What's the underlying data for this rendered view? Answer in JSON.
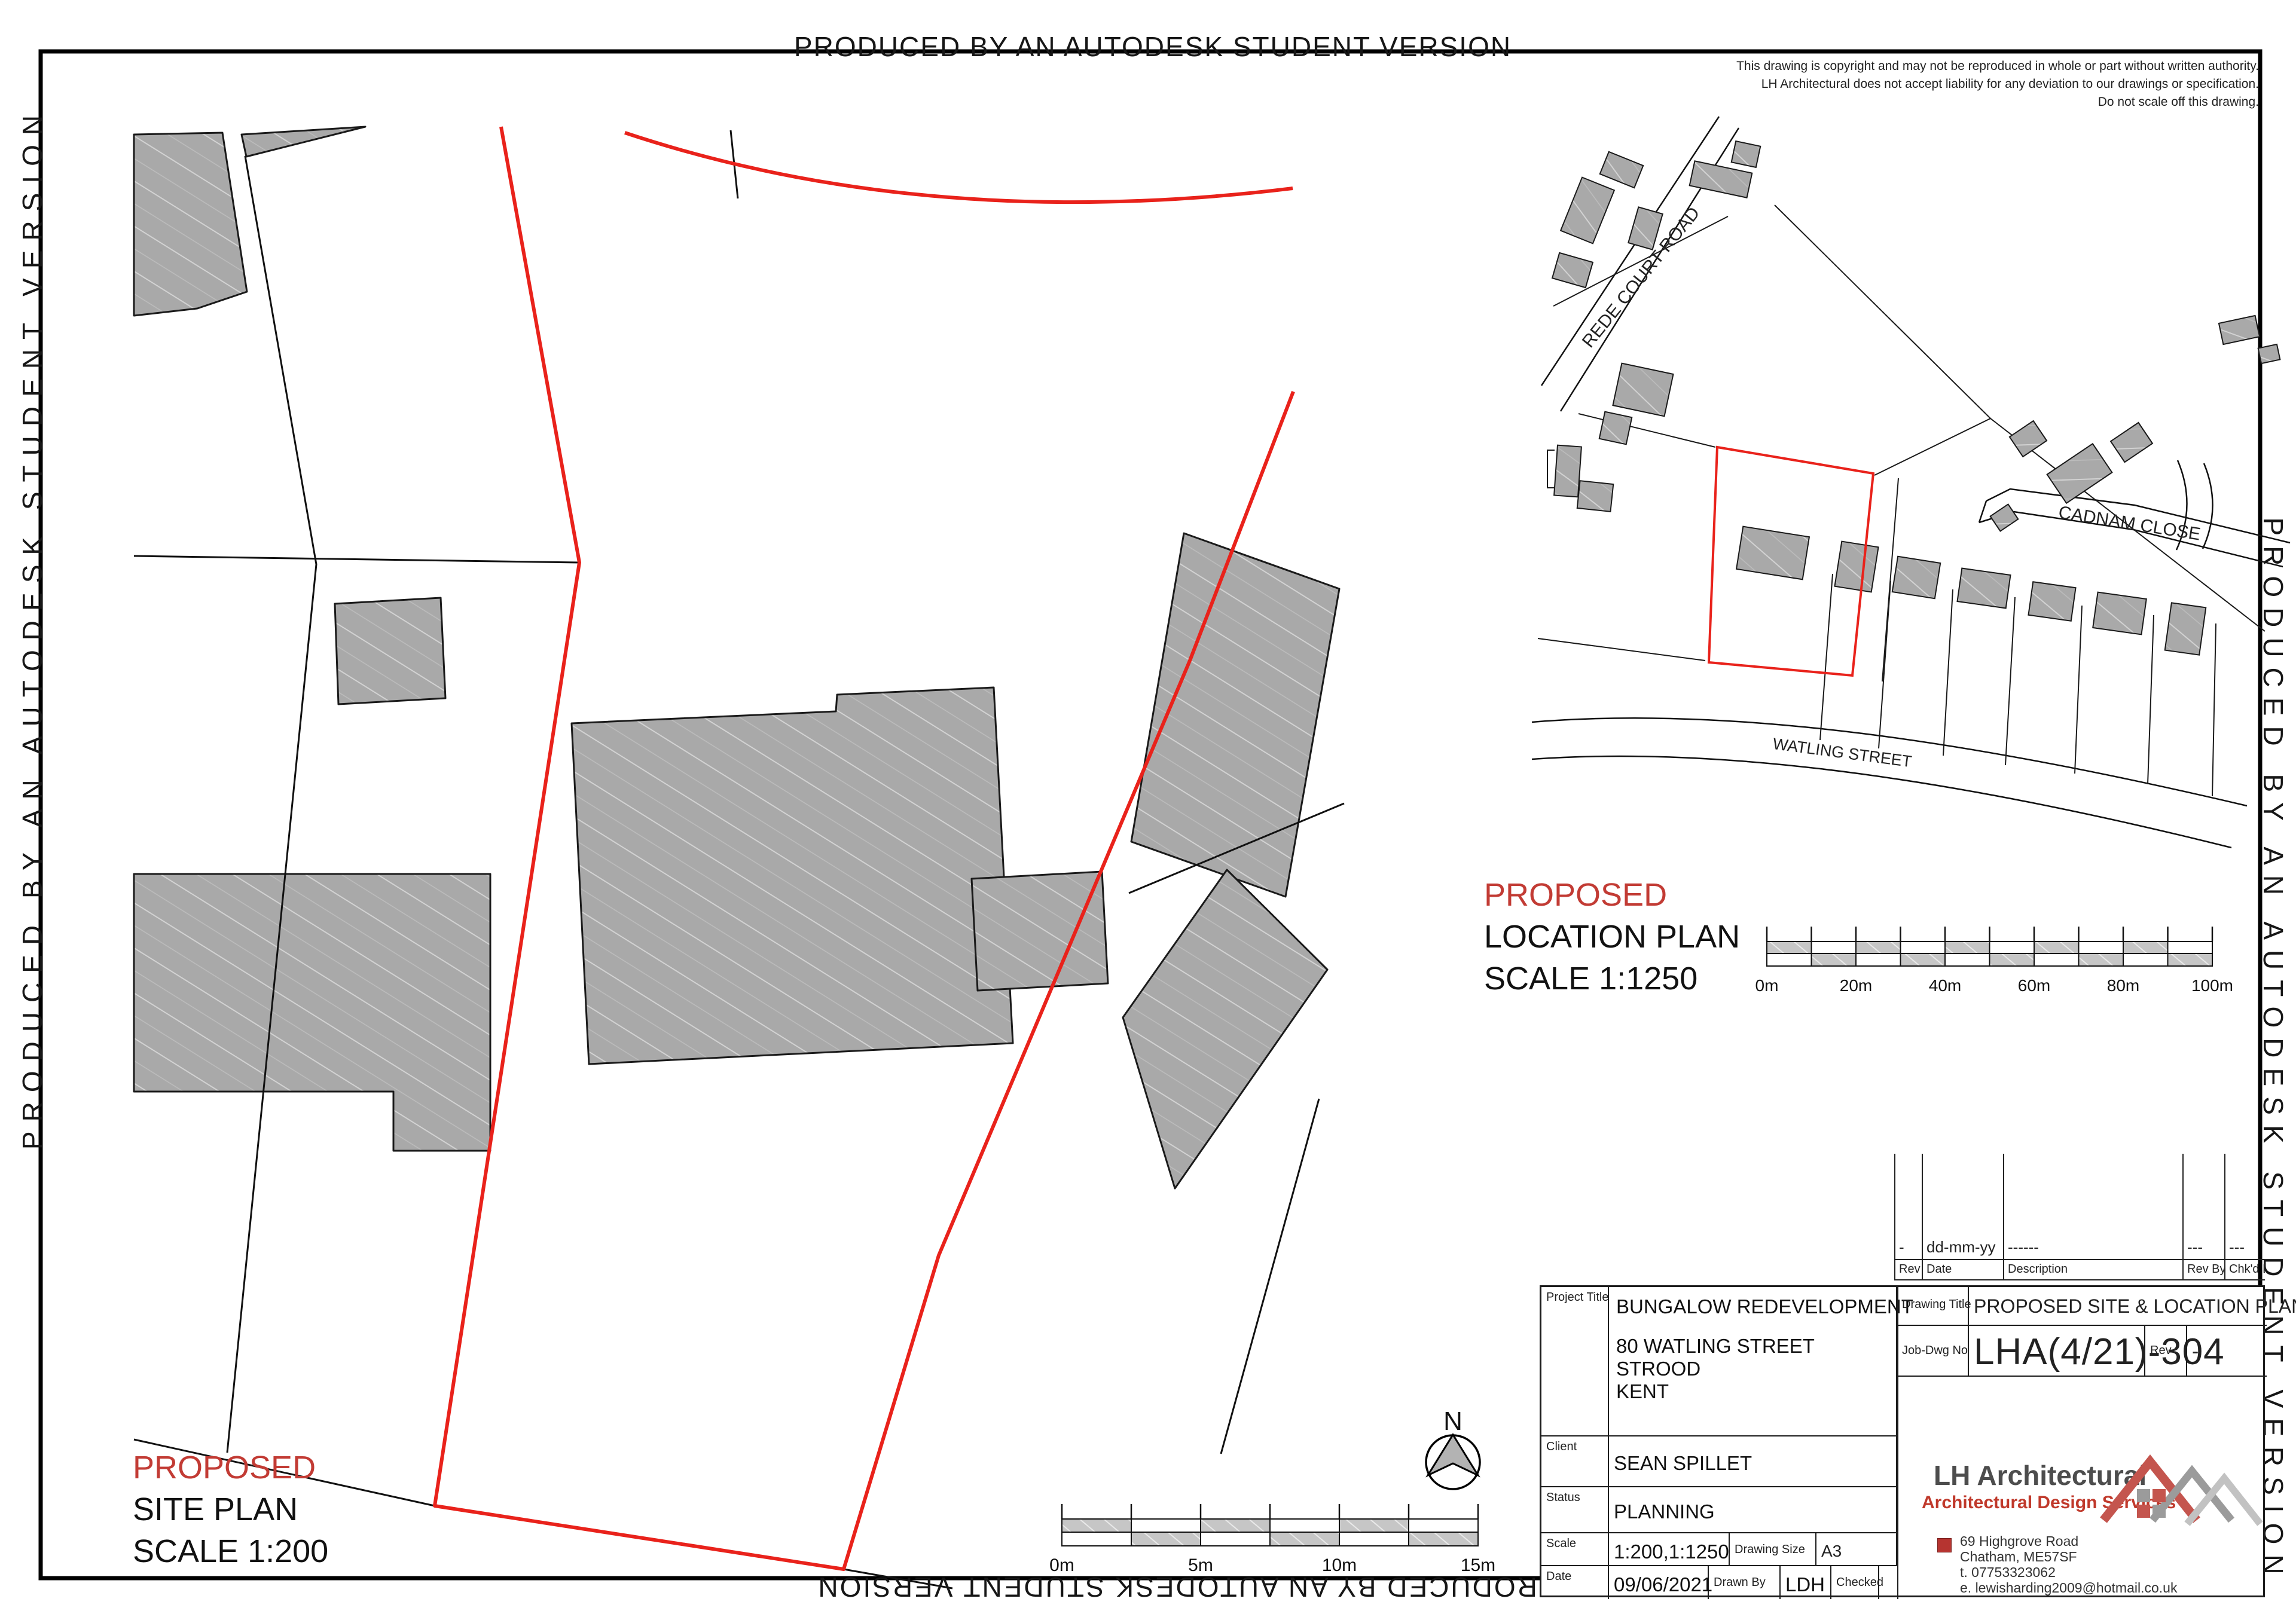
{
  "banner": {
    "text": "PRODUCED BY AN AUTODESK STUDENT VERSION"
  },
  "copyright": {
    "line1": "This drawing is copyright and may not be reproduced in whole or part without written authority.",
    "line2": "LH Architectural does not accept liability for any deviation to our drawings or specification.",
    "line3": "Do not scale off this drawing."
  },
  "location_plan": {
    "roads": {
      "rede": "REDE COURT ROAD",
      "cadnam": "CADNAM CLOSE",
      "watling": "WATLING STREET"
    },
    "caption": {
      "l1": "PROPOSED",
      "l2": "LOCATION PLAN",
      "l3": "SCALE 1:1250"
    },
    "scalebar": [
      "0m",
      "20m",
      "40m",
      "60m",
      "80m",
      "100m"
    ]
  },
  "site_plan": {
    "caption": {
      "l1": "PROPOSED",
      "l2": "SITE PLAN",
      "l3": "SCALE 1:200"
    },
    "scalebar": [
      "0m",
      "5m",
      "10m",
      "15m"
    ],
    "north_label": "N"
  },
  "revision_table": {
    "headers": [
      "Rev",
      "Date",
      "Description",
      "Rev By",
      "Chk'd By"
    ],
    "row": {
      "rev": "-",
      "date": "dd-mm-yy",
      "description": "------",
      "rev_by": "---",
      "chkd_by": "---"
    }
  },
  "title_block": {
    "labels": {
      "project_title": "Project Title",
      "client": "Client",
      "status": "Status",
      "scale": "Scale",
      "drawing_size": "Drawing Size",
      "date": "Date",
      "drawn_by": "Drawn By",
      "checked": "Checked",
      "drawing_title": "Drawing Title",
      "job_dwg_no": "Job-Dwg No",
      "rev": "Rev"
    },
    "values": {
      "project_title": "BUNGALOW REDEVELOPMENT",
      "address1": "80 WATLING STREET",
      "address2": "STROOD",
      "address3": "KENT",
      "client": "SEAN SPILLET",
      "status": "PLANNING",
      "scale": "1:200,1:1250",
      "drawing_size": "A3",
      "date": "09/06/2021",
      "drawn_by": "LDH",
      "drawing_title": "PROPOSED SITE & LOCATION PLAN",
      "job_dwg_no": "LHA(4/21)-304",
      "rev": "-"
    }
  },
  "firm": {
    "name": "LH Architectural",
    "tagline": "Architectural Design Services",
    "addr1": "69 Highgrove Road",
    "addr2": "Chatham, ME57SF",
    "addr3": "t.  07753323062",
    "addr4": "e. lewisharding2009@hotmail.co.uk"
  },
  "colors": {
    "boundary_red": "#e9221b",
    "accent_red": "#c23b34",
    "building_gray": "#a9a9a9",
    "bar_gray": "#c6c6c6"
  }
}
